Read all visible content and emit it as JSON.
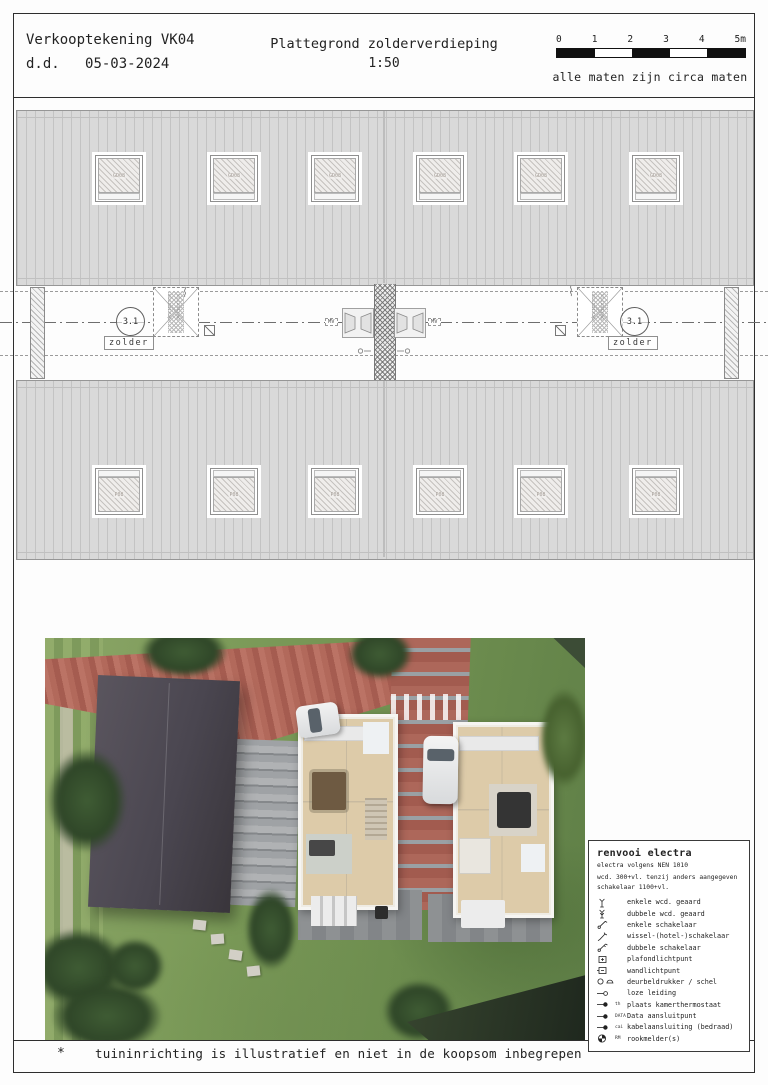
{
  "title_block": {
    "name": "Verkooptekening VK04",
    "date_label": "d.d.",
    "date": "05-03-2024",
    "drawing_title": "Plattegrond zolderverdieping",
    "scale": "1:50",
    "measures_note": "alle maten zijn circa maten"
  },
  "scale_bar": {
    "tick_labels": [
      "0",
      "1",
      "2",
      "3",
      "4",
      "5m"
    ]
  },
  "plan": {
    "room_code": "3.1",
    "room_label": "zolder",
    "mv_label": "MV",
    "loft_hatch_label": "vlizotrap",
    "skylight_label_top": "GD08",
    "skylight_label_bottom": "P08"
  },
  "legend": {
    "title": "renvooi electra",
    "subtitle": "electra volgens NEN 1010",
    "note_line1": "wcd. 300+vl. tenzij anders aangegeven",
    "note_line2": "schakelaar 1100+vl.",
    "items": [
      {
        "symbol": "single-socket",
        "label": "enkele wcd. geaard",
        "tag": ""
      },
      {
        "symbol": "double-socket",
        "label": "dubbele wcd. geaard",
        "tag": ""
      },
      {
        "symbol": "single-switch",
        "label": "enkele schakelaar",
        "tag": ""
      },
      {
        "symbol": "two-way-switch",
        "label": "wissel-(hotel-)schakelaar",
        "tag": ""
      },
      {
        "symbol": "double-switch",
        "label": "dubbele schakelaar",
        "tag": ""
      },
      {
        "symbol": "ceiling-light",
        "label": "plafondlichtpunt",
        "tag": ""
      },
      {
        "symbol": "wall-light",
        "label": "wandlichtpunt",
        "tag": ""
      },
      {
        "symbol": "doorbell",
        "label": "deurbeldrukker / schel",
        "tag": ""
      },
      {
        "symbol": "conduit",
        "label": "loze leiding",
        "tag": ""
      },
      {
        "symbol": "thermostat",
        "label": "plaats kamerthermostaat",
        "tag": "th"
      },
      {
        "symbol": "data",
        "label": "Data aansluitpunt",
        "tag": "DATA"
      },
      {
        "symbol": "cable",
        "label": "kabelaansluiting (bedraad)",
        "tag": "cai"
      },
      {
        "symbol": "smoke-detector",
        "label": "rookmelder(s)",
        "tag": "RM"
      }
    ]
  },
  "footer": {
    "marker": "*",
    "note": "tuininrichting is illustratief en niet in de koopsom inbegrepen"
  },
  "colors": {
    "roof_fill": "#d9d9d9",
    "roof_stripe": "#c3c3c3",
    "line": "#2e2e2e",
    "brick_paving": "#ad675a",
    "grass": "#75924f",
    "dark_roof": "#4a4650"
  }
}
